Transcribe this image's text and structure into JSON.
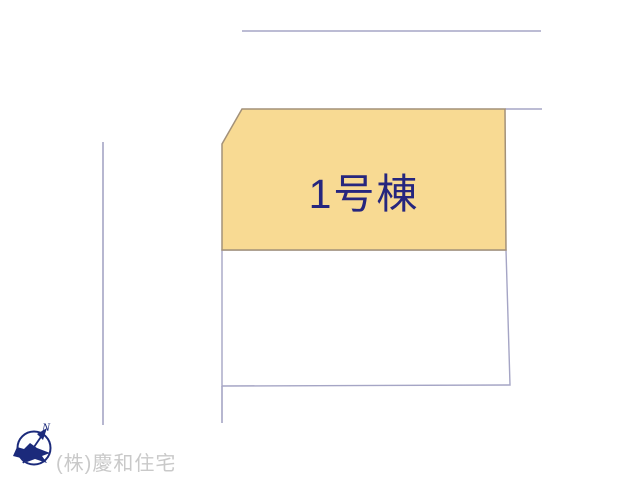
{
  "site_plan": {
    "title": "建物配置図",
    "lot": {
      "label": "1号棟",
      "fill_color": "#f8da93",
      "border_color": "#a39179",
      "label_color": "#26267e"
    },
    "adjacent_lot": {
      "fill_color": "#ffffff",
      "border_color": "#a5a5c5"
    },
    "boundary_line_color": "#a5a5c5"
  },
  "compass": {
    "north_label": "N",
    "color": "#1b2a7b"
  },
  "watermark": {
    "company_name": "(株)慶和住宅",
    "color": "#c9c9c9"
  }
}
